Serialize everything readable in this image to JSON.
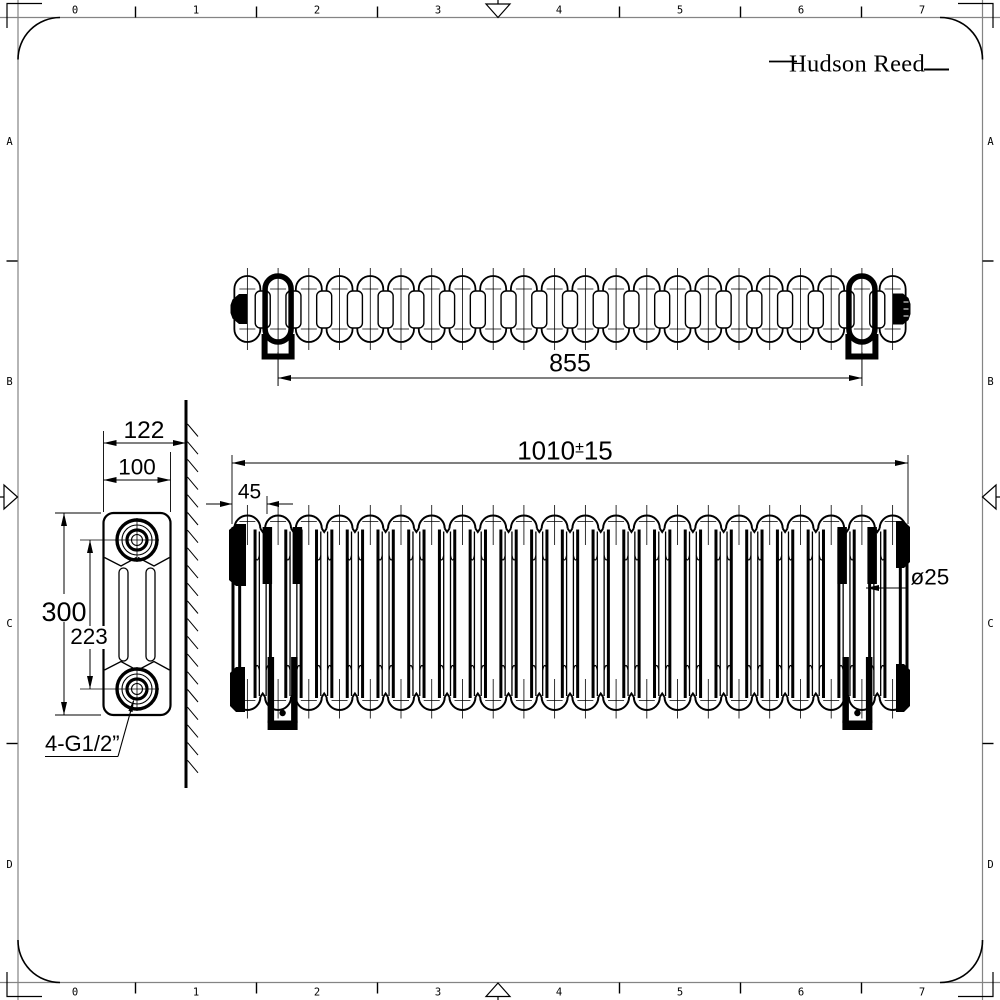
{
  "brand": {
    "logo_text": "Hudson Reed"
  },
  "sheet_frame": {
    "top_ruler_labels": [
      "0",
      "1",
      "2",
      "3",
      "4",
      "5",
      "6",
      "7"
    ],
    "bottom_ruler_labels": [
      "0",
      "1",
      "2",
      "3",
      "4",
      "5",
      "6",
      "7"
    ],
    "left_ruler_labels": [
      "A",
      "B",
      "C",
      "D"
    ],
    "right_ruler_labels": [
      "A",
      "B",
      "C",
      "D"
    ]
  },
  "drawing": {
    "description": "Horizontal column radiator technical drawing, three orthographic views",
    "section_count": 22,
    "dimensions": {
      "bracket_centres": "855",
      "overall_length": "1010",
      "overall_length_tolerance_sign": "±",
      "overall_length_tolerance": "15",
      "end_to_bracket": "45",
      "column_diameter": "ø25",
      "wall_to_front": "122",
      "section_depth": "100",
      "overall_height": "300",
      "tapping_centres": "223",
      "connections": "4-G1/2”"
    }
  }
}
